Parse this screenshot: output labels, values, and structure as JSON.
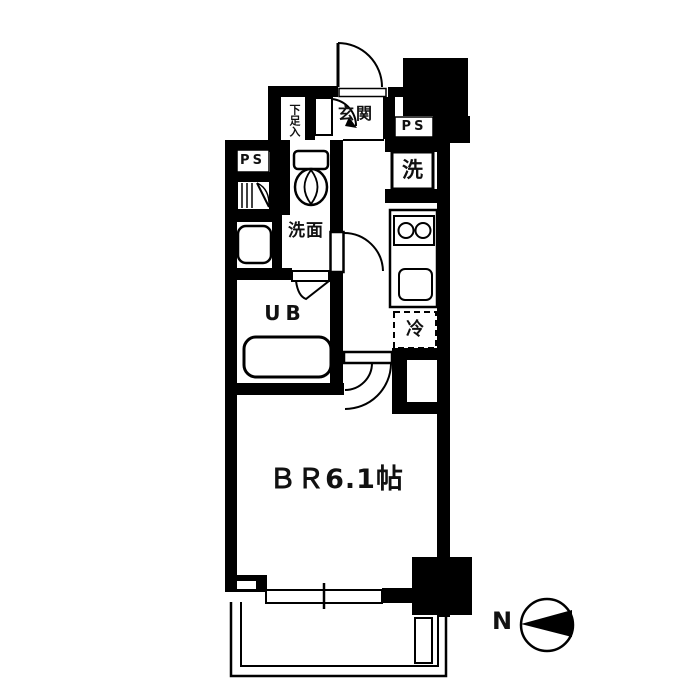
{
  "plan": {
    "type": "apartment-floor-plan",
    "labels": {
      "entrance": "玄関",
      "shoe_storage": "下足入",
      "pipe_space_top": "PS",
      "pipe_space_left": "PS",
      "washing_machine": "洗",
      "washroom": "洗面",
      "unit_bath": "UB",
      "refrigerator": "冷",
      "bedroom": "ＢＲ6.1帖",
      "bedroom_size_tatami": 6.1
    },
    "fixtures": [
      "entrance-door",
      "shoe-storage-door",
      "toilet",
      "washbasin",
      "bathtub",
      "unit-bath-folding-door",
      "washroom-door",
      "kitchen-stove-2-burner",
      "kitchen-sink",
      "washing-machine-space",
      "refrigerator-space",
      "bedroom-door",
      "sliding-window",
      "balcony",
      "balcony-partition"
    ],
    "compass": {
      "label": "N",
      "direction": "left"
    }
  },
  "colors": {
    "line": "#000000",
    "background": "#ffffff"
  }
}
